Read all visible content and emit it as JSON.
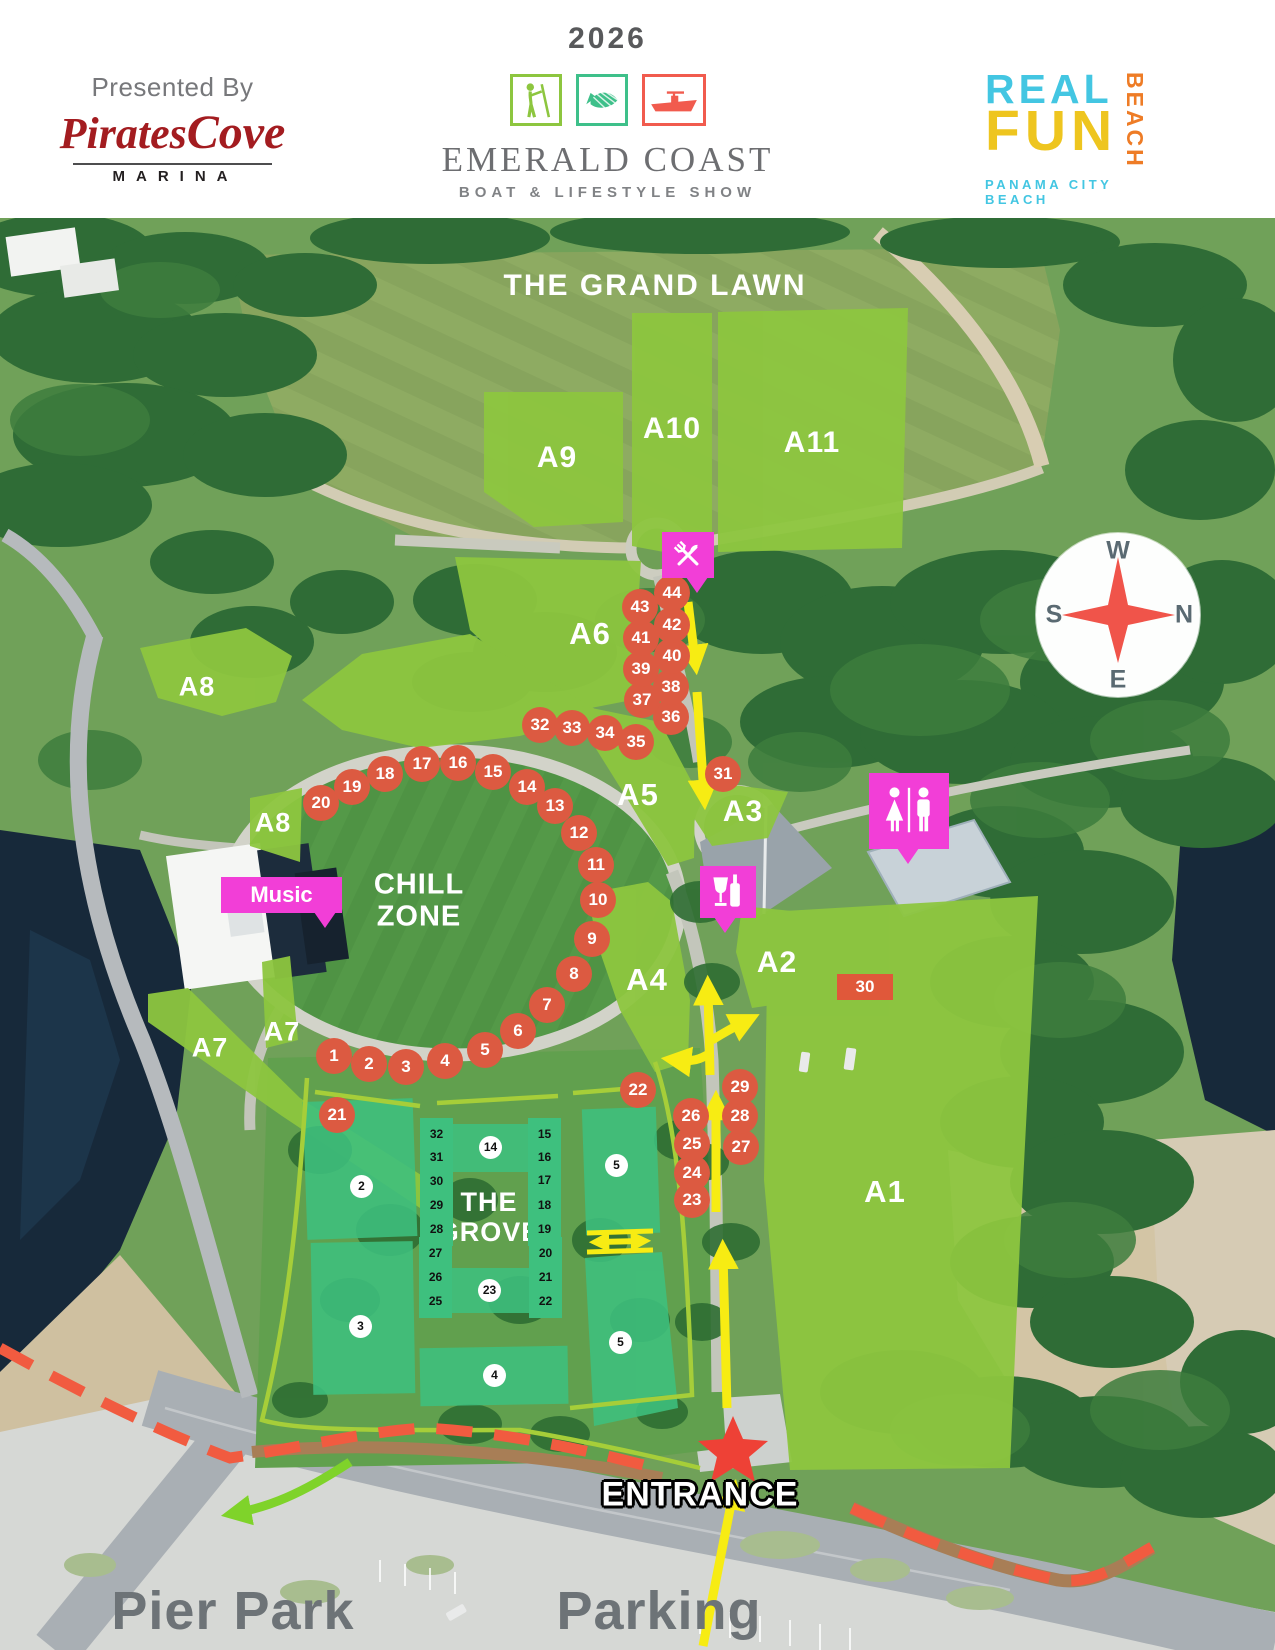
{
  "header": {
    "presented_by": "Presented By",
    "pirates_cove": {
      "name_part1": "Pirates",
      "name_part2": "Cove",
      "subtitle": "MARINA"
    },
    "year": "2026",
    "show_title": "EMERALD COAST",
    "show_subtitle": "BOAT & LIFESTYLE SHOW",
    "real_fun": {
      "word1": "REAL",
      "word2": "FUN",
      "vertical": "BEACH",
      "city": "PANAMA CITY BEACH"
    }
  },
  "map": {
    "labels": {
      "grand_lawn": "THE GRAND LAWN",
      "chill_line1": "CHILL",
      "chill_line2": "ZONE",
      "grove_line1": "THE",
      "grove_line2": "GROVE",
      "entrance": "ENTRANCE",
      "pier_park": "Pier Park",
      "parking": "Parking",
      "music": "Music"
    },
    "compass": {
      "top": "W",
      "left": "S",
      "right": "N",
      "bottom": "E"
    },
    "area_labels": [
      {
        "label": "A1",
        "x": 885,
        "y": 1192,
        "s": 31
      },
      {
        "label": "A2",
        "x": 777,
        "y": 963,
        "s": 30
      },
      {
        "label": "A3",
        "x": 743,
        "y": 812,
        "s": 30
      },
      {
        "label": "A4",
        "x": 647,
        "y": 980,
        "s": 31
      },
      {
        "label": "A5",
        "x": 638,
        "y": 795,
        "s": 31
      },
      {
        "label": "A6",
        "x": 590,
        "y": 634,
        "s": 31
      },
      {
        "label": "A7",
        "x": 210,
        "y": 1048,
        "s": 27
      },
      {
        "label": "A7",
        "x": 282,
        "y": 1032,
        "s": 27
      },
      {
        "label": "A8",
        "x": 197,
        "y": 687,
        "s": 27
      },
      {
        "label": "A8",
        "x": 273,
        "y": 823,
        "s": 27
      },
      {
        "label": "A9",
        "x": 557,
        "y": 458,
        "s": 30
      },
      {
        "label": "A10",
        "x": 672,
        "y": 429,
        "s": 30
      },
      {
        "label": "A11",
        "x": 812,
        "y": 443,
        "s": 30
      }
    ],
    "stage_marker": {
      "label": "30"
    },
    "orange_markers": [
      {
        "n": "1",
        "x": 334,
        "y": 1056
      },
      {
        "n": "2",
        "x": 369,
        "y": 1064
      },
      {
        "n": "3",
        "x": 406,
        "y": 1067
      },
      {
        "n": "4",
        "x": 445,
        "y": 1061
      },
      {
        "n": "5",
        "x": 485,
        "y": 1050
      },
      {
        "n": "6",
        "x": 518,
        "y": 1031
      },
      {
        "n": "7",
        "x": 547,
        "y": 1005
      },
      {
        "n": "8",
        "x": 574,
        "y": 974
      },
      {
        "n": "9",
        "x": 592,
        "y": 939
      },
      {
        "n": "10",
        "x": 598,
        "y": 900
      },
      {
        "n": "11",
        "x": 596,
        "y": 865
      },
      {
        "n": "12",
        "x": 579,
        "y": 833
      },
      {
        "n": "13",
        "x": 555,
        "y": 806
      },
      {
        "n": "14",
        "x": 527,
        "y": 787
      },
      {
        "n": "15",
        "x": 493,
        "y": 772
      },
      {
        "n": "16",
        "x": 458,
        "y": 763
      },
      {
        "n": "17",
        "x": 422,
        "y": 764
      },
      {
        "n": "18",
        "x": 385,
        "y": 774
      },
      {
        "n": "19",
        "x": 352,
        "y": 787
      },
      {
        "n": "20",
        "x": 321,
        "y": 803
      },
      {
        "n": "21",
        "x": 337,
        "y": 1115
      },
      {
        "n": "22",
        "x": 638,
        "y": 1090
      },
      {
        "n": "23",
        "x": 692,
        "y": 1200
      },
      {
        "n": "24",
        "x": 692,
        "y": 1173
      },
      {
        "n": "25",
        "x": 692,
        "y": 1144
      },
      {
        "n": "26",
        "x": 691,
        "y": 1116
      },
      {
        "n": "27",
        "x": 741,
        "y": 1147
      },
      {
        "n": "28",
        "x": 740,
        "y": 1116
      },
      {
        "n": "29",
        "x": 740,
        "y": 1087
      },
      {
        "n": "31",
        "x": 723,
        "y": 774
      },
      {
        "n": "32",
        "x": 540,
        "y": 725
      },
      {
        "n": "33",
        "x": 572,
        "y": 728
      },
      {
        "n": "34",
        "x": 605,
        "y": 733
      },
      {
        "n": "35",
        "x": 636,
        "y": 742
      },
      {
        "n": "36",
        "x": 671,
        "y": 717
      },
      {
        "n": "37",
        "x": 642,
        "y": 700
      },
      {
        "n": "38",
        "x": 671,
        "y": 687
      },
      {
        "n": "39",
        "x": 641,
        "y": 669
      },
      {
        "n": "40",
        "x": 672,
        "y": 656
      },
      {
        "n": "41",
        "x": 641,
        "y": 638
      },
      {
        "n": "42",
        "x": 672,
        "y": 625
      },
      {
        "n": "43",
        "x": 640,
        "y": 607
      },
      {
        "n": "44",
        "x": 672,
        "y": 593
      }
    ],
    "grove_markers": [
      {
        "n": "32",
        "x": 437,
        "y": 1135,
        "sq": 1
      },
      {
        "n": "31",
        "x": 437,
        "y": 1158,
        "sq": 1
      },
      {
        "n": "30",
        "x": 437,
        "y": 1182,
        "sq": 1
      },
      {
        "n": "29",
        "x": 437,
        "y": 1206,
        "sq": 1
      },
      {
        "n": "28",
        "x": 437,
        "y": 1230,
        "sq": 1
      },
      {
        "n": "27",
        "x": 436,
        "y": 1254,
        "sq": 1
      },
      {
        "n": "26",
        "x": 436,
        "y": 1278,
        "sq": 1
      },
      {
        "n": "25",
        "x": 436,
        "y": 1302,
        "sq": 1
      },
      {
        "n": "15",
        "x": 545,
        "y": 1135,
        "sq": 1
      },
      {
        "n": "16",
        "x": 545,
        "y": 1158,
        "sq": 1
      },
      {
        "n": "17",
        "x": 545,
        "y": 1181,
        "sq": 1
      },
      {
        "n": "18",
        "x": 545,
        "y": 1206,
        "sq": 1
      },
      {
        "n": "19",
        "x": 545,
        "y": 1230,
        "sq": 1
      },
      {
        "n": "20",
        "x": 546,
        "y": 1254,
        "sq": 1
      },
      {
        "n": "21",
        "x": 546,
        "y": 1278,
        "sq": 1
      },
      {
        "n": "22",
        "x": 546,
        "y": 1302,
        "sq": 1
      },
      {
        "n": "14",
        "x": 491,
        "y": 1148,
        "sq": 0
      },
      {
        "n": "23",
        "x": 490,
        "y": 1291,
        "sq": 0
      },
      {
        "n": "2",
        "x": 362,
        "y": 1187,
        "sq": 0
      },
      {
        "n": "3",
        "x": 361,
        "y": 1327,
        "sq": 0
      },
      {
        "n": "4",
        "x": 495,
        "y": 1376,
        "sq": 0
      },
      {
        "n": "5",
        "x": 617,
        "y": 1166,
        "sq": 0
      },
      {
        "n": "5",
        "x": 621,
        "y": 1343,
        "sq": 0
      }
    ],
    "icons": [
      "food-icon",
      "drinks-icon",
      "restrooms-icon",
      "music-callout",
      "compass-rose",
      "entrance-star"
    ]
  },
  "colors": {
    "lime": "#8dc63f",
    "teal": "#3ec07e",
    "marker": "#dc5a41",
    "magenta": "#f23ed7",
    "yellow": "#f7ec13",
    "red-dash": "#f15b40",
    "star-red": "#ee4136",
    "cyan": "#43c6e2",
    "gold": "#eec51f",
    "orange": "#ee7c26",
    "dark-red": "#a31c20",
    "gray-text": "#6d7377"
  }
}
